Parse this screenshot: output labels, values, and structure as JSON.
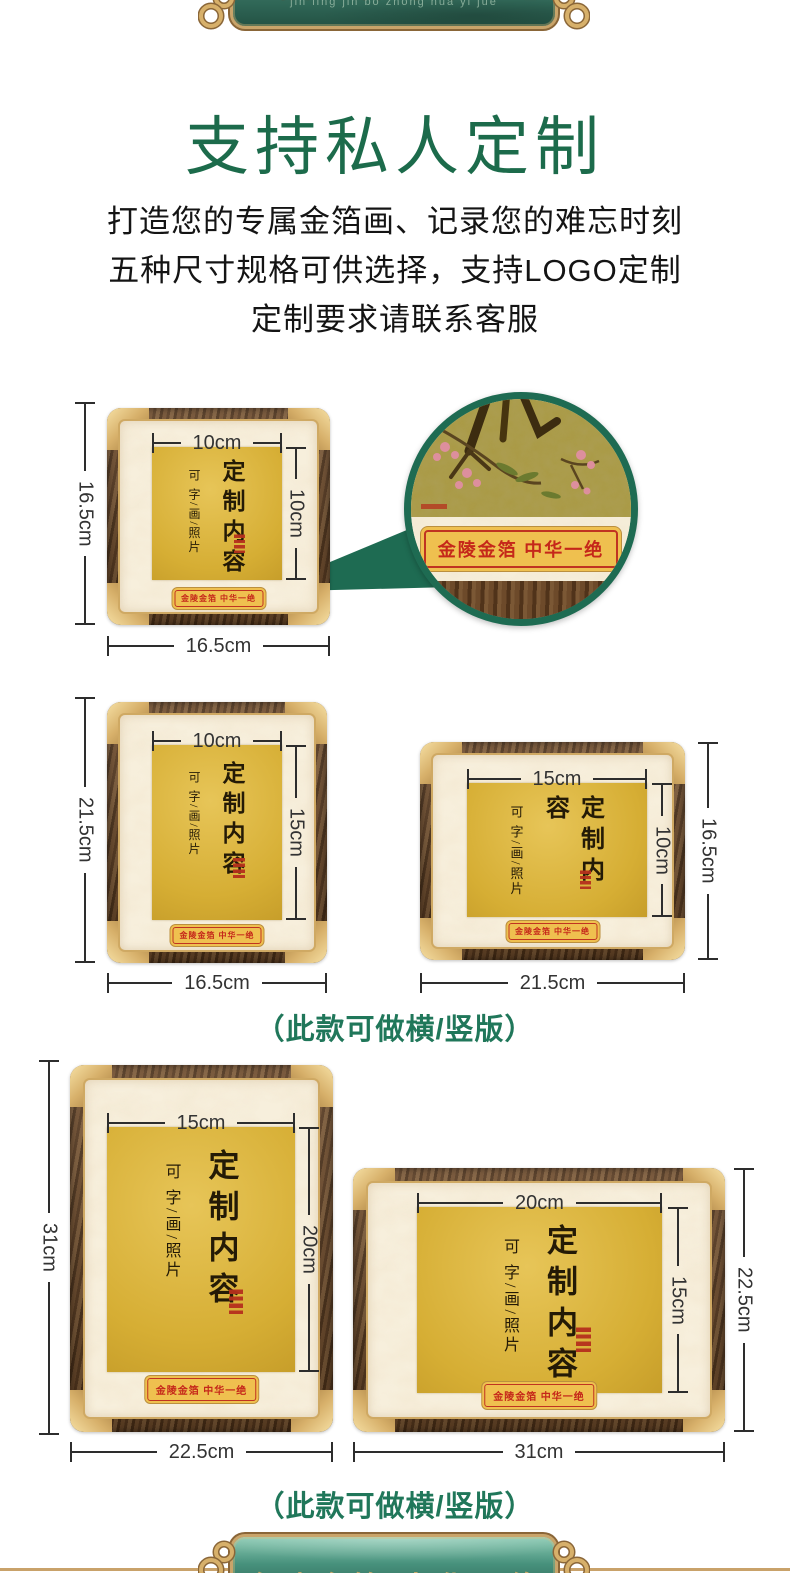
{
  "banner_top": {
    "title": "金陵金箔 中华一绝",
    "pinyin": "jin ling jin bo zhong hua yi jue"
  },
  "banner_bottom": {
    "title": "金陵金箔 中华一绝"
  },
  "header": {
    "title": "支持私人定制",
    "desc_lines": [
      "打造您的专属金箔画、记录您的难忘时刻",
      "五种尺寸规格可供选择，支持LOGO定制",
      "定制要求请联系客服"
    ]
  },
  "frame_content": {
    "custom_text": "定制内容",
    "options_text": "可 字/画/照片",
    "brand_label": "金陵金箔 中华一绝"
  },
  "frames": [
    {
      "outer_height": "16.5cm",
      "outer_width": "16.5cm",
      "inner_width": "10cm",
      "inner_height": "10cm"
    },
    {
      "outer_height": "21.5cm",
      "outer_width": "16.5cm",
      "inner_width": "10cm",
      "inner_height": "15cm"
    },
    {
      "outer_height": "16.5cm",
      "outer_width": "21.5cm",
      "inner_width": "15cm",
      "inner_height": "10cm"
    },
    {
      "outer_height": "31cm",
      "outer_width": "22.5cm",
      "inner_width": "15cm",
      "inner_height": "20cm"
    },
    {
      "outer_height": "22.5cm",
      "outer_width": "31cm",
      "inner_width": "20cm",
      "inner_height": "15cm"
    }
  ],
  "captions": {
    "orientation_note": "（此款可做横/竖版）"
  },
  "colors": {
    "title_green": "#1c6b4b",
    "banner_green": "#2f6656",
    "banner_gold": "#c9a46a",
    "accent_red": "#c23a20",
    "foil_gold": "#d6ae34",
    "wood_brown": "#5d3c20"
  }
}
